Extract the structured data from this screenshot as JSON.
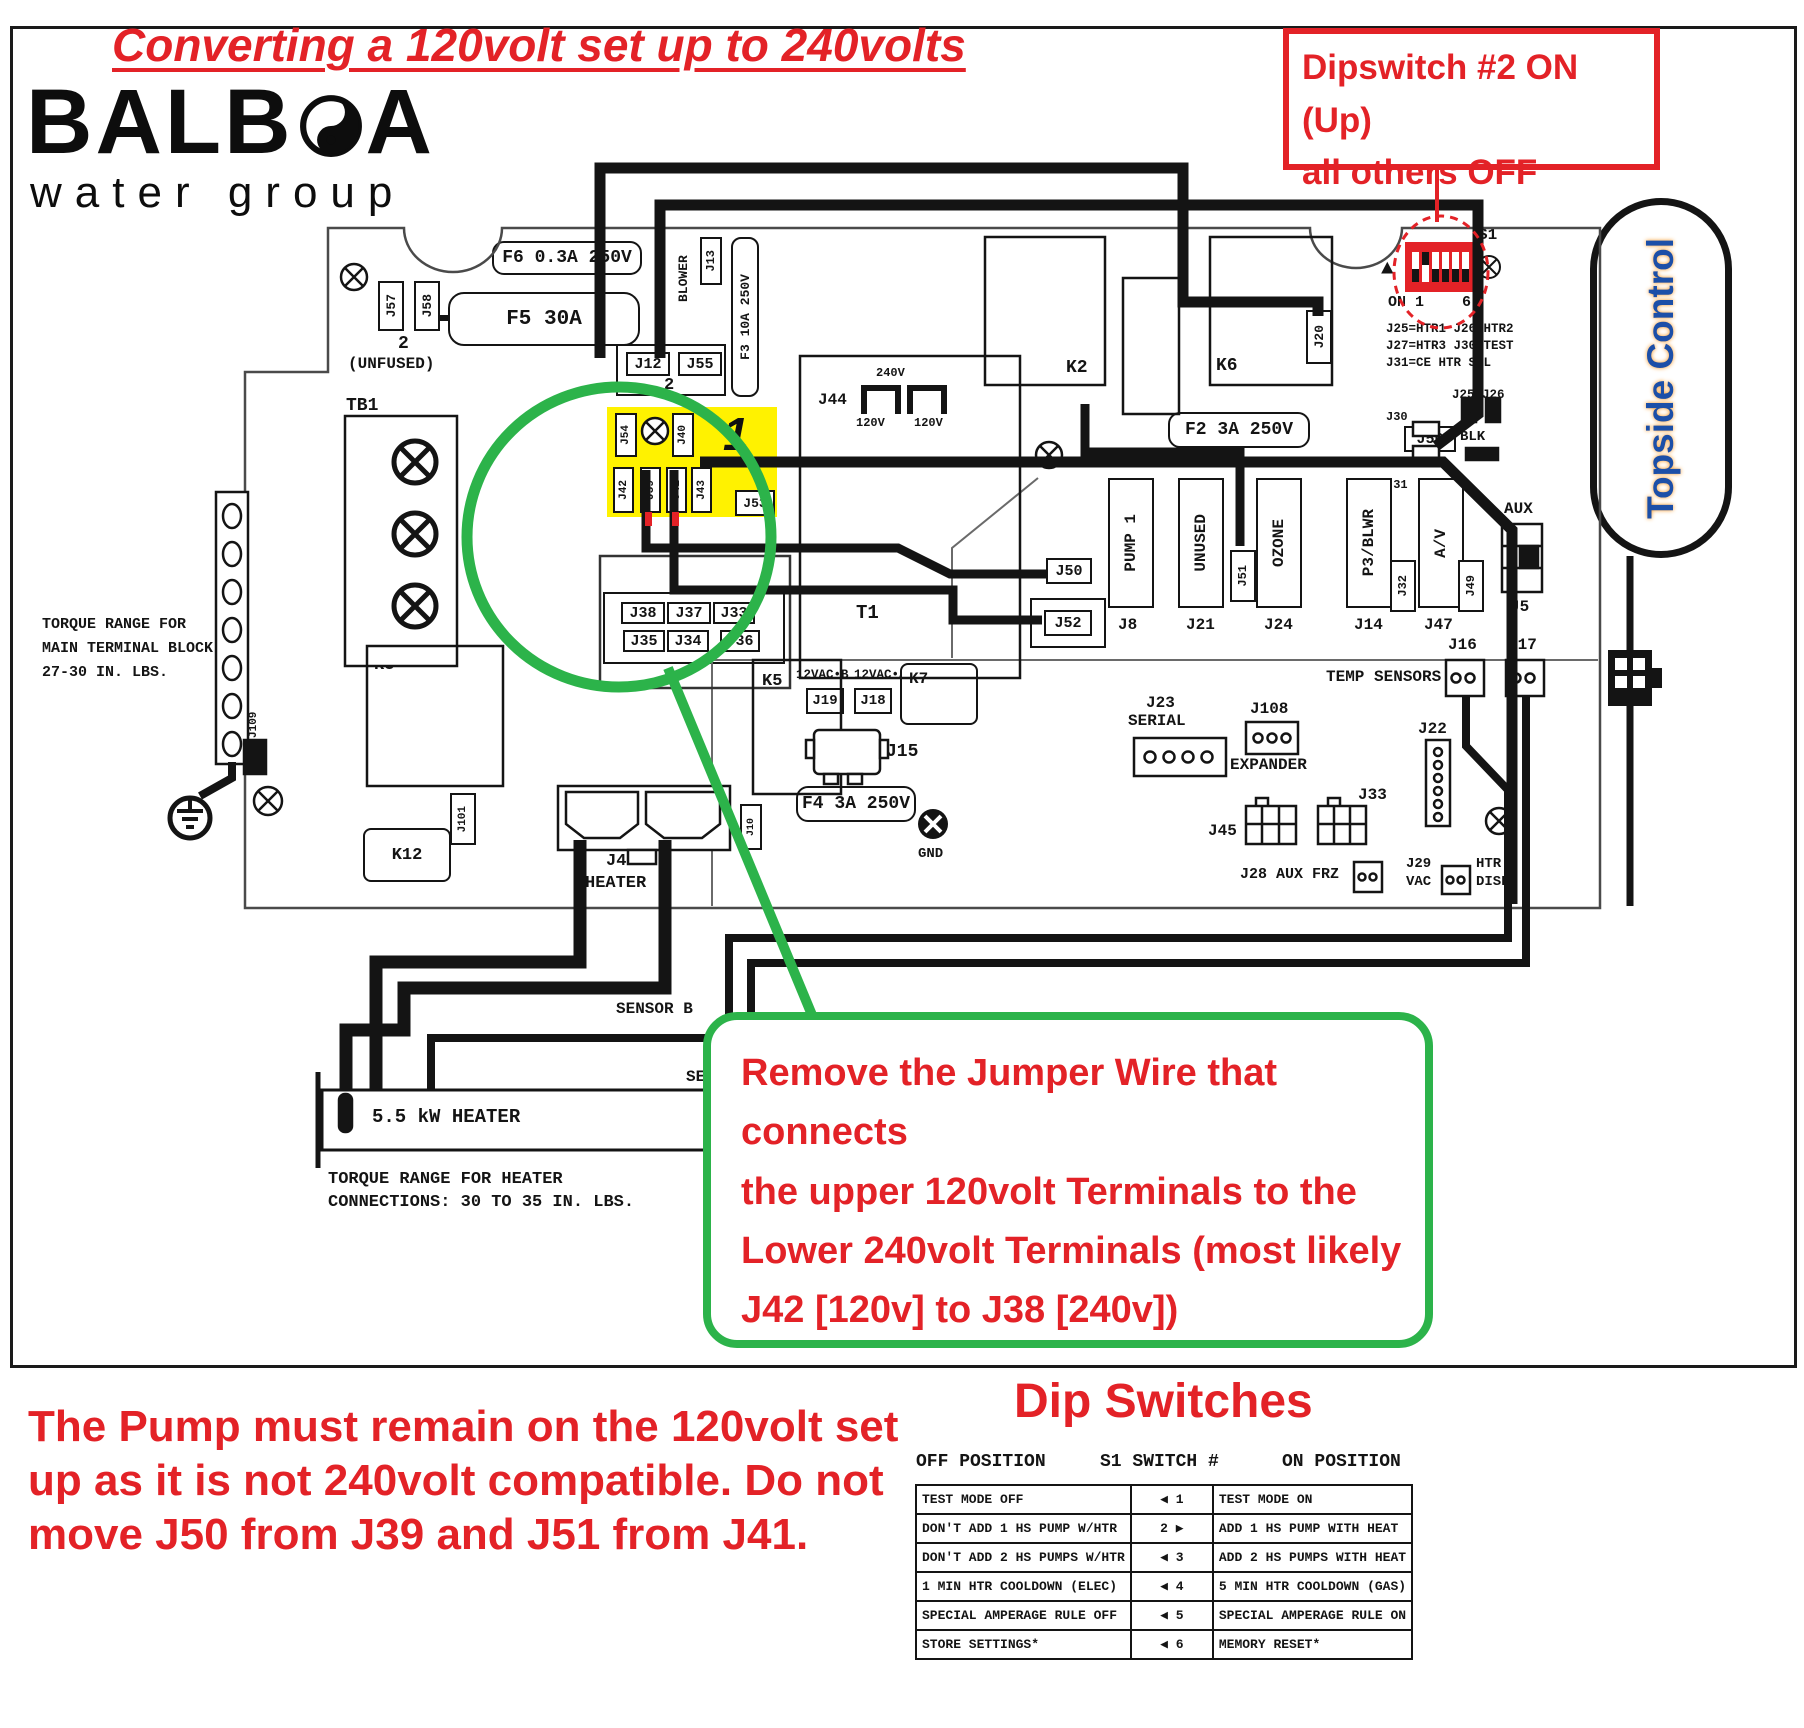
{
  "title": "Converting a 120volt set up to 240volts",
  "logo": {
    "brand_left": "BALB",
    "brand_right": "A",
    "sub": "water group"
  },
  "dipswitch_callout": {
    "line1": "Dipswitch #2 ON (Up)",
    "line2": "all others OFF"
  },
  "jumper_callout": {
    "line1": "Remove the Jumper Wire that connects",
    "line2": "the upper 120volt Terminals to the",
    "line3": "Lower 240volt Terminals (most likely",
    "line4": "J42 [120v] to J38 [240v])"
  },
  "pump_note": {
    "line1": "The Pump must remain on the 120volt set",
    "line2": "up as it is not 240volt compatible. Do not",
    "line3": "move J50 from J39 and J51 from J41."
  },
  "topside": "Topside Control",
  "torque_main": {
    "line1": "TORQUE RANGE FOR",
    "line2": "MAIN TERMINAL BLOCK:",
    "line3": "27-30 IN. LBS."
  },
  "torque_heater": {
    "line1": "TORQUE RANGE FOR HEATER",
    "line2": "CONNECTIONS: 30 TO 35 IN. LBS."
  },
  "heater": {
    "label": "5.5 kW HEATER",
    "sensor_a": "SENSOR A",
    "sensor_b": "SENSOR B"
  },
  "board": {
    "f6": "F6 0.3A 250V",
    "f5": "F5 30A",
    "f3": "F3 10A 250V",
    "f2": "F2 3A 250V",
    "f4": "F4 3A 250V",
    "j57": "J57",
    "j58": "J58",
    "unfused_num": "2",
    "unfused": "(UNFUSED)",
    "blower": "BLOWER",
    "j13": "J13",
    "j12": "J12",
    "j55": "J55",
    "j12_num": "2",
    "tb1": "TB1",
    "tb1_1": "1",
    "tb1_2": "2",
    "tb1_3": "3",
    "j44": "J44",
    "v240": "240V",
    "v120": "120V",
    "v120b": "120V",
    "k2": "K2",
    "k6": "K6",
    "j20": "J20",
    "s1": "S1",
    "on_arrow": "▲",
    "on_label": "ON 1",
    "six": "6",
    "legend1": "J25=HTR1 J26=HTR2",
    "legend2": "J27=HTR3 J30=TEST",
    "legend3": "J31=CE HTR SEL",
    "j25_26": "J25 J26",
    "j30": "J30",
    "j31": "J31",
    "j27": "J27",
    "j56": "J56",
    "blk": "BLK",
    "big1": "1",
    "j54": "J54",
    "j40": "J40",
    "j42": "J42",
    "j39": "J39",
    "j41": "J41",
    "j43": "J43",
    "j53": "J53",
    "j38": "J38",
    "j37": "J37",
    "j33_jumper": "J33",
    "j35": "J35",
    "j34": "J34",
    "j36": "J36",
    "t1": "T1",
    "j50": "J50",
    "j52": "J52",
    "pump1": "PUMP 1",
    "j8": "J8",
    "unused": "UNUSED",
    "j21": "J21",
    "ozone": "OZONE",
    "j24": "J24",
    "p3blwr": "P3/BLWR",
    "j14": "J14",
    "av": "A/V",
    "j47": "J47",
    "j51": "J51",
    "j32": "J32",
    "j49": "J49",
    "aux": "AUX",
    "j5": "J5",
    "temp_sensors": "TEMP SENSORS",
    "j16": "J16",
    "j17": "J17",
    "k3": "K3",
    "k5": "K5",
    "k7": "K7",
    "k12": "K12",
    "vac_b": "12VAC•B",
    "j19": "J19",
    "vac_a": "12VAC•A",
    "j18": "J18",
    "light": "LIGHT",
    "j15": "J15",
    "gnd": "GND",
    "j23": "J23",
    "serial": "SERIAL",
    "j108": "J108",
    "expander": "EXPANDER",
    "j22": "J22",
    "j33": "J33",
    "j45": "J45",
    "j28": "J28 AUX FRZ",
    "j29": "J29",
    "vac": "VAC",
    "htr": "HTR",
    "disbl": "DISBL",
    "j101": "J101",
    "j109": "J109",
    "j10": "J10",
    "j46": "J46",
    "heater": "HEATER"
  },
  "dip_table": {
    "title": "Dip Switches",
    "col_off": "OFF POSITION",
    "col_sw": "S1 SWITCH #",
    "col_on": "ON POSITION",
    "rows": [
      {
        "off": "TEST MODE OFF",
        "sw": "◀ 1",
        "on": "TEST MODE ON"
      },
      {
        "off": "DON'T ADD 1 HS PUMP W/HTR",
        "sw": "2 ▶",
        "on": "ADD 1 HS PUMP WITH HEAT"
      },
      {
        "off": "DON'T ADD 2 HS PUMPS W/HTR",
        "sw": "◀ 3",
        "on": "ADD 2 HS PUMPS WITH HEAT"
      },
      {
        "off": "1 MIN HTR COOLDOWN (ELEC)",
        "sw": "◀ 4",
        "on": "5 MIN HTR COOLDOWN (GAS)"
      },
      {
        "off": "SPECIAL AMPERAGE RULE OFF",
        "sw": "◀ 5",
        "on": "SPECIAL AMPERAGE RULE ON"
      },
      {
        "off": "STORE SETTINGS*",
        "sw": "◀ 6",
        "on": "MEMORY RESET*"
      }
    ]
  }
}
